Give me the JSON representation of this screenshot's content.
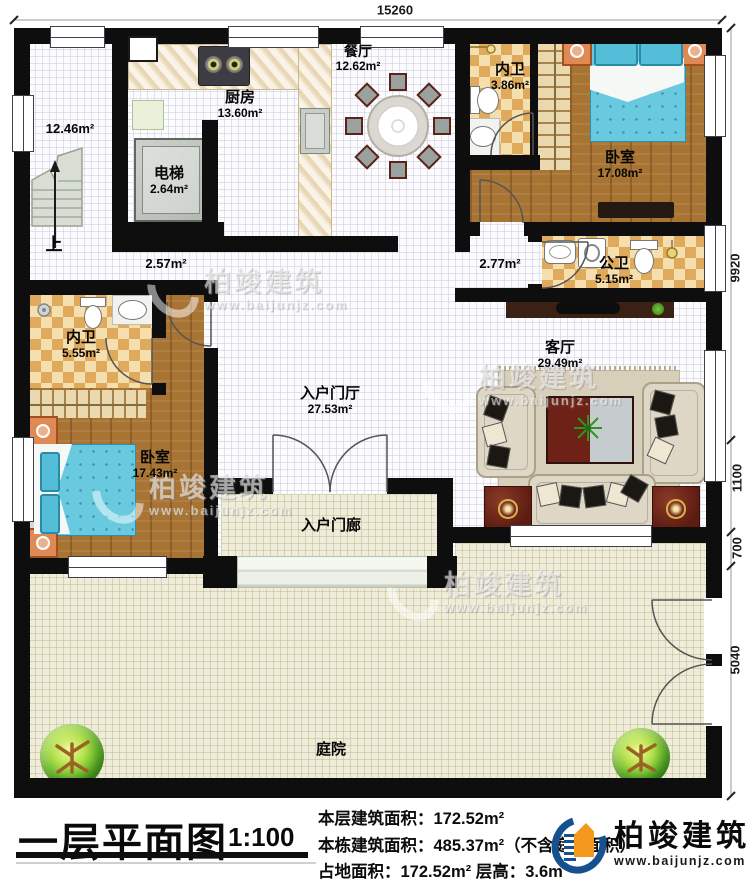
{
  "plan": {
    "dimensions": {
      "top": "15260",
      "right": [
        "9920",
        "1100",
        "700",
        "5040"
      ]
    },
    "rooms": {
      "stair_area": {
        "area": "12.46m²",
        "up_label": "上"
      },
      "elevator": {
        "name": "电梯",
        "area": "2.64m²"
      },
      "kitchen": {
        "name": "厨房",
        "area": "13.60m²"
      },
      "dining": {
        "name": "餐厅",
        "area": "12.62m²"
      },
      "bath_top": {
        "name": "内卫",
        "area": "3.86m²"
      },
      "bedroom_top": {
        "name": "卧室",
        "area": "17.08m²"
      },
      "public_bath": {
        "name": "公卫",
        "area": "5.15m²"
      },
      "corridor_left": {
        "area": "2.57m²"
      },
      "corridor_right": {
        "area": "2.77m²"
      },
      "bath_left": {
        "name": "内卫",
        "area": "5.55m²"
      },
      "bedroom_left": {
        "name": "卧室",
        "area": "17.43m²"
      },
      "entrance_hall": {
        "name": "入户门厅",
        "area": "27.53m²"
      },
      "living": {
        "name": "客厅",
        "area": "29.49m²"
      },
      "porch": {
        "name": "入户门廊"
      },
      "courtyard": {
        "name": "庭院"
      }
    }
  },
  "watermark": {
    "brand": "柏竣建筑",
    "url": "www.baijunjz.com"
  },
  "title_block": {
    "title": "一层平面图",
    "scale": "1:100",
    "stats": [
      "本层建筑面积：172.52m²",
      "本栋建筑面积：485.37m²（不含庭院面积）",
      "占地面积：172.52m²  层高：3.6m"
    ],
    "logo": {
      "brand": "柏竣建筑",
      "url": "www.baijunjz.com"
    }
  },
  "colors": {
    "wall": "#0e0e0e",
    "wood_floor": "#a87434",
    "tile_light": "#f6dfae",
    "tile_dark": "#e0aa5c",
    "bed_blue": "#69c9de",
    "courtyard_beige": "#efecd9",
    "logo_blue": "#17508e",
    "logo_orange": "#f2991e"
  }
}
